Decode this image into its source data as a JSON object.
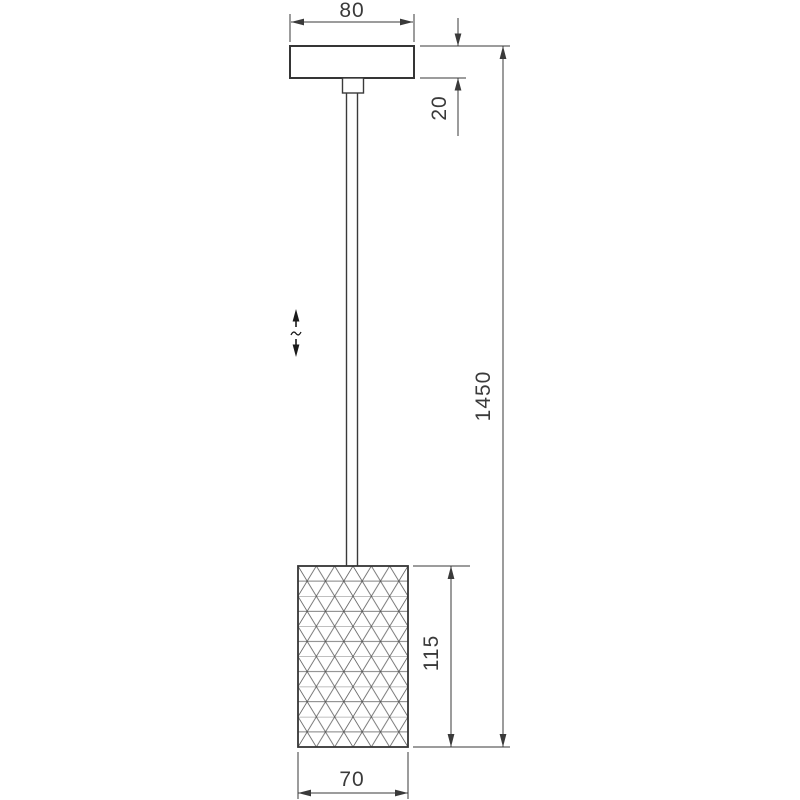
{
  "drawing": {
    "title": "pendant-lamp-dimension-drawing",
    "dimensions": {
      "canopy_width": "80",
      "canopy_height": "20",
      "overall_height": "1450",
      "shade_height": "115",
      "shade_width": "70"
    },
    "icons": {
      "height_adjustable": "double-arrow-with-break"
    },
    "colors": {
      "line": "#3a3a3a",
      "pattern_line": "#555555",
      "background": "#ffffff"
    }
  }
}
